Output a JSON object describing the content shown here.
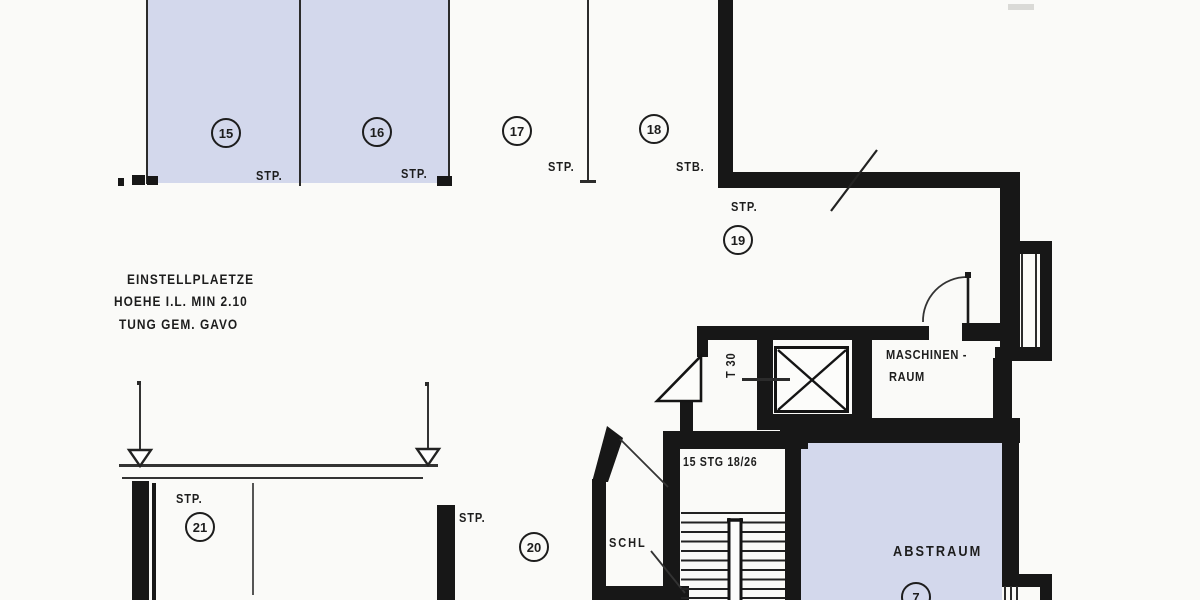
{
  "colors": {
    "paper": "#fafaf8",
    "ink": "#171717",
    "shade": "#d3d8ec"
  },
  "annotation": {
    "line1": "EINSTELLPLAETZE",
    "line2": "HOEHE I.L. MIN 2.10",
    "line3": "TUNG GEM. GAVO"
  },
  "parking_spaces": [
    {
      "number": "15",
      "tag": "STP."
    },
    {
      "number": "16",
      "tag": "STP."
    },
    {
      "number": "17",
      "tag": "STP."
    },
    {
      "number": "18",
      "tag": "STB."
    },
    {
      "number": "19",
      "tag": "STP."
    },
    {
      "number": "20",
      "tag": "STP."
    },
    {
      "number": "21",
      "tag": "STP."
    }
  ],
  "rooms": {
    "maschinenraum_line1": "MASCHINEN -",
    "maschinenraum_line2": "RAUM",
    "abstraum_label": "ABSTRAUM",
    "abstraum_number": "7",
    "stair_label": "15 STG 18/26",
    "vestibule_label": "SCHL",
    "fire_door_label": "T 30"
  }
}
